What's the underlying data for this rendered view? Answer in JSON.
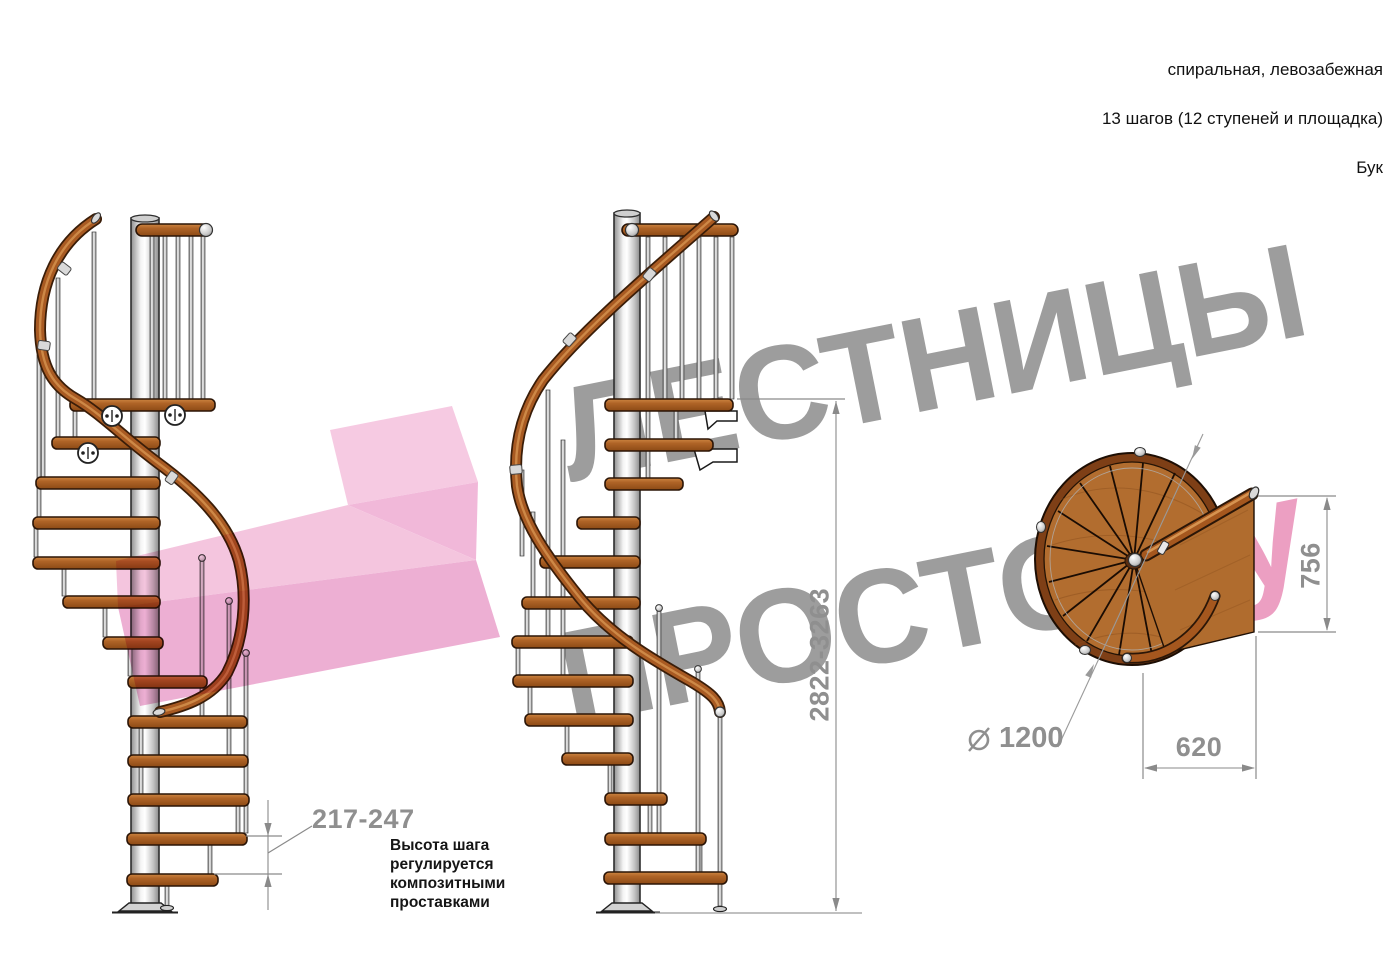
{
  "header": {
    "line1": "спиральная, левозабежная",
    "line2": "13 шагов (12 ступеней и площадка)",
    "line3": "Бук"
  },
  "watermark": {
    "word1": "ЛЕСТНИЦЫ",
    "word2": "ПРОСТО",
    "suffix": ".ру"
  },
  "dimensions": {
    "total_height": "2822-3263",
    "step_height": "217-247",
    "landing_depth": "756",
    "landing_width": "620",
    "diameter_symbol": "⌀",
    "diameter": "1200"
  },
  "note": {
    "text": "Высота шага\nрегулируется\nкомпозитными\nпроставками"
  },
  "colors": {
    "wood": "#b06427",
    "handrail": "#a85a22",
    "pole": "#d9d9d9",
    "watermark_gray": "#9d9d9d",
    "watermark_pink": "#ec9fc2",
    "arrow_pink": "#f4c0dc",
    "dimension_gray": "#8f8f8f"
  }
}
